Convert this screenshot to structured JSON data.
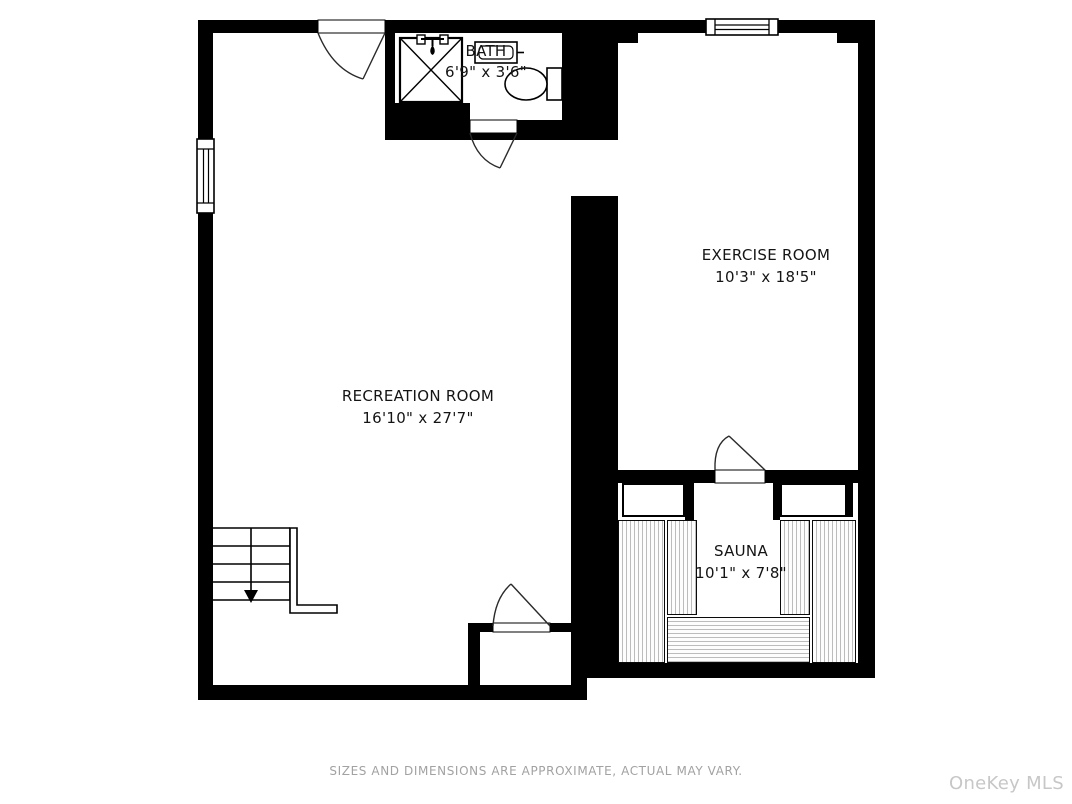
{
  "floor_plan": {
    "title": "Basement floor plan",
    "rooms": [
      {
        "name": "RECREATION ROOM",
        "dimensions": "16'10\" x 27'7\""
      },
      {
        "name": "EXERCISE ROOM",
        "dimensions": "10'3\" x 18'5\""
      },
      {
        "name": "SAUNA",
        "dimensions": "10'1\" x 7'8\""
      },
      {
        "name": "BATH",
        "dimensions": "6'9\" x 3'6\""
      }
    ],
    "fixtures": [
      "shower",
      "sink",
      "toilet",
      "staircase-down",
      "sauna-benches",
      "doors",
      "windows"
    ],
    "colors": {
      "wall": "#000000",
      "background": "#ffffff",
      "bench_stripe": "#bcbcbc",
      "label_text": "#141414",
      "footer_text": "#a2a2a2",
      "watermark_text": "#c7c7c7"
    }
  },
  "footer": {
    "disclaimer": "SIZES AND DIMENSIONS ARE APPROXIMATE, ACTUAL MAY VARY."
  },
  "watermark": {
    "label": "OneKey MLS"
  }
}
